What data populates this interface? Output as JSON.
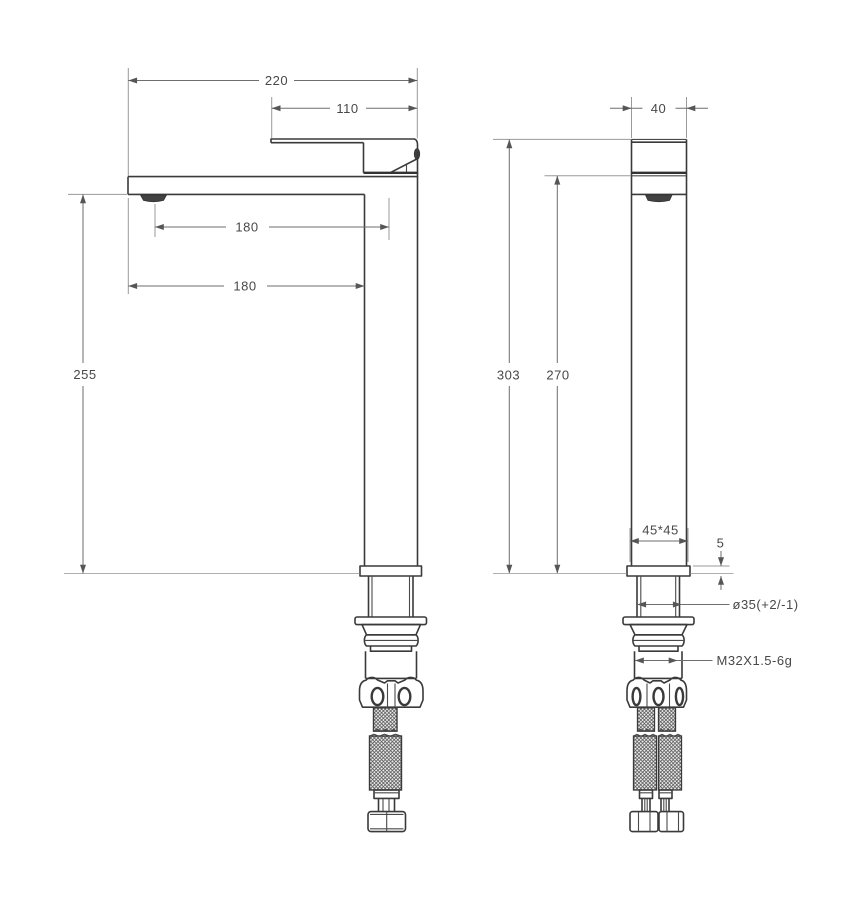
{
  "colors": {
    "ink": "#3a3a3a",
    "dimension": "#6e6e6e"
  },
  "views": {
    "front": {
      "dims": {
        "overall_width": "220",
        "handle_reach": "110",
        "spout_to_axis": "180",
        "spout_overhang": "180",
        "outlet_height": "255"
      }
    },
    "side": {
      "dims": {
        "top_width": "40",
        "total_height": "303",
        "upper_height": "270",
        "body_section": "45*45",
        "plate_thickness": "5",
        "mount_hole": "ø35(+2/-1)",
        "thread": "M32X1.5-6g"
      }
    }
  }
}
